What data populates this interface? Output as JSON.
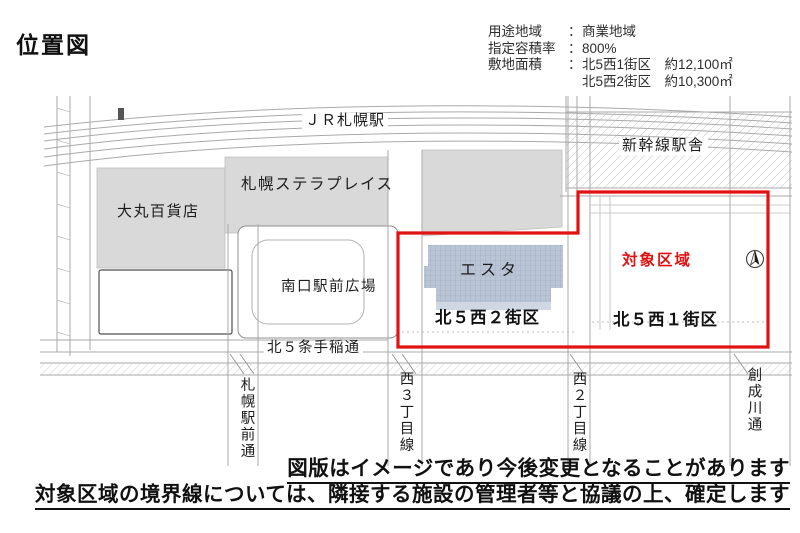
{
  "page": {
    "title": "位置図"
  },
  "info": {
    "rows": [
      {
        "label": "用途地域",
        "colon": "：",
        "value": "商業地域"
      },
      {
        "label": "指定容積率",
        "colon": "：",
        "value": "800%"
      },
      {
        "label": "敷地面積",
        "colon": "：",
        "value": "北5西1街区　約12,100㎡"
      },
      {
        "label": "",
        "colon": "",
        "value": "北5西2街区　約10,300㎡"
      }
    ]
  },
  "map": {
    "labels": {
      "jr_station": "ＪＲ札幌駅",
      "shinkansen": "新幹線駅舎",
      "stellar_place": "札幌ステラプレイス",
      "daimaru": "大丸百貨店",
      "plaza": "南口駅前広場",
      "esta": "エスタ",
      "target_area": "対象区域",
      "block_west2": "北５西２街区",
      "block_west1": "北５西１街区",
      "teine_street": "北５条手稲通",
      "street_ekimae": "札幌駅前通",
      "street_nishi3": "西３丁目線",
      "street_nishi2": "西２丁目線",
      "street_sosei": "創成川通"
    },
    "colors": {
      "boundary_red": "#e01212",
      "target_text_red": "#e01212",
      "building_gray": "#d9d9d9",
      "esta_blue": "#b9c5d4"
    }
  },
  "notes": {
    "line1": "図版はイメージであり今後変更となることがあります",
    "line2": "対象区域の境界線については、隣接する施設の管理者等と協議の上、確定します"
  }
}
